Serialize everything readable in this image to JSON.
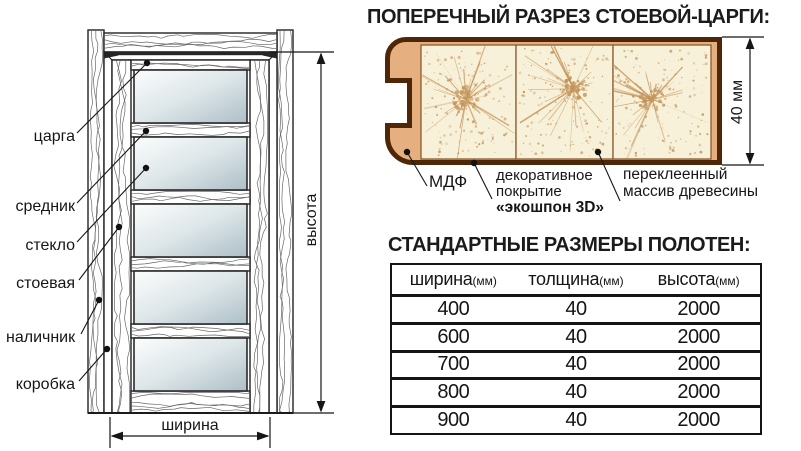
{
  "door_diagram": {
    "part_labels": [
      "царга",
      "средник",
      "стекло",
      "стоевая",
      "наличник",
      "коробка"
    ],
    "height_label": "высота",
    "width_label": "ширина"
  },
  "cross_section": {
    "title": "ПОПЕРЕЧНЫЙ РАЗРЕЗ СТОЕВОЙ-ЦАРГИ:",
    "thickness_label": "40 мм",
    "callouts": {
      "mdf": "МДФ",
      "coating": [
        "декоративное",
        "покрытие",
        "«экошпон 3D»"
      ],
      "core": [
        "переклеенный",
        "массив древесины"
      ]
    }
  },
  "size_table": {
    "title": "СТАНДАРТНЫЕ РАЗМЕРЫ ПОЛОТЕН:",
    "columns": [
      {
        "name": "ширина",
        "unit": "(мм)"
      },
      {
        "name": "толщина",
        "unit": "(мм)"
      },
      {
        "name": "высота",
        "unit": "(мм)"
      }
    ],
    "rows": [
      [
        "400",
        "40",
        "2000"
      ],
      [
        "600",
        "40",
        "2000"
      ],
      [
        "700",
        "40",
        "2000"
      ],
      [
        "800",
        "40",
        "2000"
      ],
      [
        "900",
        "40",
        "2000"
      ]
    ]
  },
  "colors": {
    "ink": "#1a1a1a",
    "section_outline": "#4e2708",
    "section_fill": "#e5af7f",
    "section_panel": "#f8f1da",
    "section_speckle": "#c4945a",
    "grain": "#4e4e4e"
  }
}
